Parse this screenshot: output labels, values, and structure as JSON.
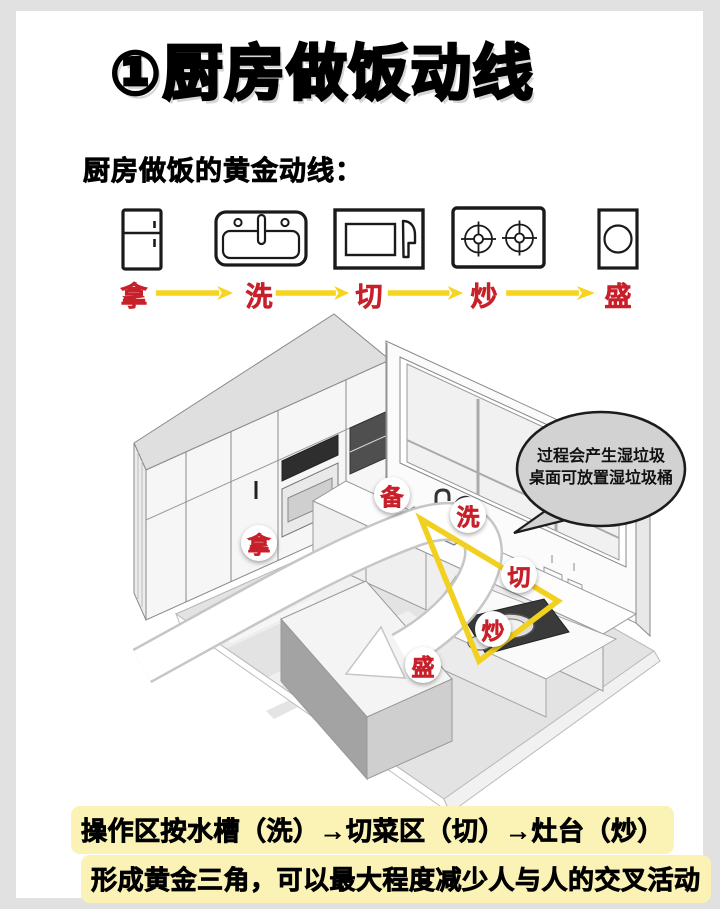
{
  "header": {
    "title": "①厨房做饭动线",
    "subtitle": "厨房做饭的黄金动线："
  },
  "flow": {
    "steps": [
      {
        "icon": "fridge-icon",
        "label": "拿"
      },
      {
        "icon": "sink-icon",
        "label": "洗"
      },
      {
        "icon": "cutting-board-icon",
        "label": "切"
      },
      {
        "icon": "stove-icon",
        "label": "炒"
      },
      {
        "icon": "serving-bowl-icon",
        "label": "盛"
      }
    ]
  },
  "diagram": {
    "zone_labels": [
      {
        "name": "take",
        "label": "拿"
      },
      {
        "name": "prep",
        "label": "备"
      },
      {
        "name": "wash",
        "label": "洗"
      },
      {
        "name": "cut",
        "label": "切"
      },
      {
        "name": "stir-fry",
        "label": "炒"
      },
      {
        "name": "serve",
        "label": "盛"
      }
    ],
    "speech_bubble": {
      "line1": "过程会产生湿垃圾",
      "line2": "桌面可放置湿垃圾桶"
    }
  },
  "footer": {
    "line1": "操作区按水槽（洗）→切菜区（切）→灶台（炒）",
    "line2": "形成黄金三角，可以最大程度减少人与人的交叉活动"
  },
  "colors": {
    "accent_red": "#c8202a",
    "arrow_yellow": "#f6d41f",
    "triangle_yellow": "#f2d01f",
    "highlight_yellow": "#fbf2b6",
    "bubble_gray": "#d2d2d2",
    "page_bg": "#e1e1e1"
  }
}
